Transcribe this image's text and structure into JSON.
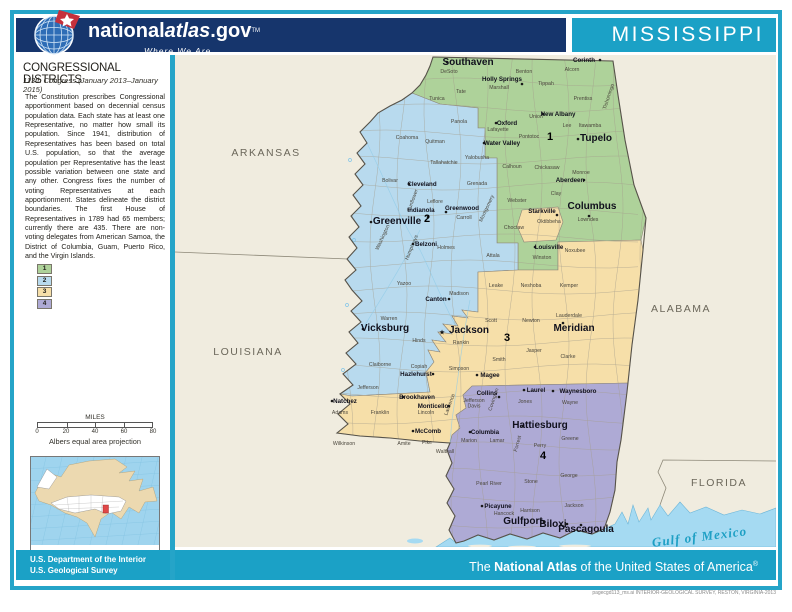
{
  "header": {
    "brand_prefix": "national",
    "brand_italic": "atlas",
    "brand_suffix": ".gov",
    "trademark": "TM",
    "tagline": "Where We Are",
    "state_title": "MISSISSIPPI"
  },
  "sidebar": {
    "title": "CONGRESSIONAL DISTRICTS",
    "subtitle": "113th Congress (January 2013–January 2015)",
    "body": "The Constitution prescribes Congressional apportionment based on decennial census population data.  Each state has at least one Representative, no matter how small its population.  Since 1941, distribution of Representatives has been based on total U.S. population, so that the average population per Representative has the least possible variation between one state and any other.  Congress fixes the number of voting Representatives at each apportionment.  States delineate the district boundaries.  The first House of Representatives in 1789 had 65 members; currently there are 435.  There are non-voting delegates from American Samoa, the District of Columbia, Guam, Puerto Rico, and the Virgin Islands.",
    "legend": [
      {
        "district": "1",
        "color": "#aed29a"
      },
      {
        "district": "2",
        "color": "#b8daee"
      },
      {
        "district": "3",
        "color": "#f6dfa9"
      },
      {
        "district": "4",
        "color": "#aeaad5"
      }
    ],
    "scale": {
      "label": "MILES",
      "ticks": [
        "0",
        "20",
        "40",
        "60",
        "80"
      ],
      "projection": "Albers equal area projection"
    }
  },
  "footer": {
    "doi_line1": "U.S. Department of the Interior",
    "doi_line2": "U.S. Geological Survey",
    "atlas_prefix": "The ",
    "atlas_bold": "National Atlas",
    "atlas_suffix": " of the United States of America",
    "atlas_reg": "®",
    "fine_print": "pagecgd113_ms.ai  INTERIOR-GEOLOGICAL SURVEY, RESTON, VIRGINIA-2013"
  },
  "map": {
    "colors": {
      "land": "#f0ecdf",
      "water": "#a5daf2",
      "district1": "#aed29a",
      "district2": "#b8daee",
      "district3": "#f6dfa9",
      "district4": "#aeaad5",
      "inset_water": "#9fd4ee",
      "inset_land": "#ecd9b0",
      "inset_us": "#ffffff",
      "inset_state": "#e04848"
    },
    "neighbors": [
      {
        "n": "ARKANSAS",
        "x": 266,
        "y": 156
      },
      {
        "n": "LOUISIANA",
        "x": 248,
        "y": 355
      },
      {
        "n": "ALABAMA",
        "x": 681,
        "y": 312
      },
      {
        "n": "FLORIDA",
        "x": 719,
        "y": 486
      }
    ],
    "water_label": {
      "n": "Gulf of Mexico",
      "x": 700,
      "y": 541,
      "r": -7
    },
    "district_numbers": [
      {
        "n": "1",
        "x": 550,
        "y": 140
      },
      {
        "n": "2",
        "x": 427,
        "y": 222
      },
      {
        "n": "3",
        "x": 507,
        "y": 341
      },
      {
        "n": "4",
        "x": 543,
        "y": 459
      }
    ],
    "cities": [
      {
        "n": "Southaven",
        "x": 468,
        "y": 65,
        "s": "b",
        "mx": 447,
        "my": 62
      },
      {
        "n": "Corinth",
        "x": 584,
        "y": 62,
        "s": "s",
        "mx": 600,
        "my": 60
      },
      {
        "n": "Holly Springs",
        "x": 502,
        "y": 81,
        "s": "s",
        "mx": 522,
        "my": 84
      },
      {
        "n": "New Albany",
        "x": 558,
        "y": 116,
        "s": "s",
        "mx": 543,
        "my": 114
      },
      {
        "n": "Oxford",
        "x": 507,
        "y": 125,
        "s": "s",
        "mx": 496,
        "my": 123
      },
      {
        "n": "Tupelo",
        "x": 596,
        "y": 141,
        "s": "b",
        "mx": 578,
        "my": 139
      },
      {
        "n": "Water Valley",
        "x": 502,
        "y": 145,
        "s": "s",
        "mx": 484,
        "my": 143
      },
      {
        "n": "Cleveland",
        "x": 422,
        "y": 186,
        "s": "s",
        "mx": 409,
        "my": 184
      },
      {
        "n": "Greenwood",
        "x": 462,
        "y": 210,
        "s": "s",
        "mx": 446,
        "my": 212
      },
      {
        "n": "Indianola",
        "x": 421,
        "y": 212,
        "s": "s",
        "mx": 428,
        "my": 217
      },
      {
        "n": "Greenville",
        "x": 397,
        "y": 224,
        "s": "b",
        "mx": 371,
        "my": 222
      },
      {
        "n": "Belzoni",
        "x": 426,
        "y": 246,
        "s": "s",
        "mx": 413,
        "my": 244
      },
      {
        "n": "Aberdeen",
        "x": 570,
        "y": 182,
        "s": "s",
        "mx": 584,
        "my": 180
      },
      {
        "n": "Starkville",
        "x": 542,
        "y": 213,
        "s": "s",
        "mx": 557,
        "my": 215
      },
      {
        "n": "Columbus",
        "x": 592,
        "y": 209,
        "s": "b",
        "mx": 589,
        "my": 216
      },
      {
        "n": "Louisville",
        "x": 549,
        "y": 249,
        "s": "s",
        "mx": 535,
        "my": 247
      },
      {
        "n": "Canton",
        "x": 436,
        "y": 301,
        "s": "s",
        "mx": 449,
        "my": 299
      },
      {
        "n": "Vicksburg",
        "x": 385,
        "y": 331,
        "s": "b",
        "mx": 363,
        "my": 329
      },
      {
        "n": "Jackson",
        "x": 469,
        "y": 333,
        "s": "b",
        "star": true,
        "mx": 442,
        "my": 332
      },
      {
        "n": "Meridian",
        "x": 574,
        "y": 331,
        "s": "b",
        "mx": 563,
        "my": 323
      },
      {
        "n": "Hazlehurst",
        "x": 416,
        "y": 376,
        "s": "s",
        "mx": 433,
        "my": 374
      },
      {
        "n": "Magee",
        "x": 490,
        "y": 377,
        "s": "s",
        "mx": 477,
        "my": 375
      },
      {
        "n": "Natchez",
        "x": 345,
        "y": 403,
        "s": "s",
        "mx": 332,
        "my": 401
      },
      {
        "n": "Brookhaven",
        "x": 417,
        "y": 399,
        "s": "s",
        "mx": 403,
        "my": 397
      },
      {
        "n": "Monticello",
        "x": 433,
        "y": 408,
        "s": "s",
        "mx": 449,
        "my": 406
      },
      {
        "n": "Collins",
        "x": 487,
        "y": 395,
        "s": "s",
        "mx": 499,
        "my": 397
      },
      {
        "n": "Laurel",
        "x": 536,
        "y": 392,
        "s": "s",
        "mx": 524,
        "my": 390
      },
      {
        "n": "Waynesboro",
        "x": 578,
        "y": 393,
        "s": "s",
        "mx": 553,
        "my": 391
      },
      {
        "n": "McComb",
        "x": 428,
        "y": 433,
        "s": "s",
        "mx": 413,
        "my": 431
      },
      {
        "n": "Columbia",
        "x": 485,
        "y": 434,
        "s": "s",
        "mx": 470,
        "my": 432
      },
      {
        "n": "Hattiesburg",
        "x": 540,
        "y": 428,
        "s": "b",
        "mx": 523,
        "my": 426
      },
      {
        "n": "Picayune",
        "x": 498,
        "y": 508,
        "s": "s",
        "mx": 482,
        "my": 506
      },
      {
        "n": "Gulfport",
        "x": 523,
        "y": 524,
        "s": "b",
        "mx": 544,
        "my": 522
      },
      {
        "n": "Biloxi",
        "x": 553,
        "y": 527,
        "s": "b",
        "mx": 567,
        "my": 524
      },
      {
        "n": "Pascagoula",
        "x": 586,
        "y": 532,
        "s": "b",
        "mx": 581,
        "my": 525
      }
    ],
    "counties": [
      {
        "n": "DeSoto",
        "x": 449,
        "y": 73
      },
      {
        "n": "Tunica",
        "x": 437,
        "y": 100
      },
      {
        "n": "Tate",
        "x": 461,
        "y": 93
      },
      {
        "n": "Marshall",
        "x": 499,
        "y": 89
      },
      {
        "n": "Benton",
        "x": 524,
        "y": 73
      },
      {
        "n": "Tippah",
        "x": 546,
        "y": 85
      },
      {
        "n": "Alcorn",
        "x": 572,
        "y": 71
      },
      {
        "n": "Tishomingo",
        "x": 610,
        "y": 97,
        "r": -72
      },
      {
        "n": "Prentiss",
        "x": 583,
        "y": 100
      },
      {
        "n": "Union",
        "x": 536,
        "y": 118
      },
      {
        "n": "Lee",
        "x": 567,
        "y": 127
      },
      {
        "n": "Itawamba",
        "x": 590,
        "y": 127
      },
      {
        "n": "Pontotoc",
        "x": 529,
        "y": 138
      },
      {
        "n": "Lafayette",
        "x": 498,
        "y": 131
      },
      {
        "n": "Panola",
        "x": 459,
        "y": 123
      },
      {
        "n": "Yalobusha",
        "x": 477,
        "y": 159
      },
      {
        "n": "Calhoun",
        "x": 512,
        "y": 168
      },
      {
        "n": "Chickasaw",
        "x": 547,
        "y": 169
      },
      {
        "n": "Monroe",
        "x": 581,
        "y": 174
      },
      {
        "n": "Webster",
        "x": 517,
        "y": 202
      },
      {
        "n": "Clay",
        "x": 556,
        "y": 195
      },
      {
        "n": "Oktibbeha",
        "x": 549,
        "y": 223
      },
      {
        "n": "Choctaw",
        "x": 514,
        "y": 229
      },
      {
        "n": "Lowndes",
        "x": 588,
        "y": 221
      },
      {
        "n": "Winston",
        "x": 542,
        "y": 259
      },
      {
        "n": "Noxubee",
        "x": 575,
        "y": 252
      },
      {
        "n": "Coahoma",
        "x": 407,
        "y": 139
      },
      {
        "n": "Quitman",
        "x": 435,
        "y": 143
      },
      {
        "n": "Tallahatchie",
        "x": 444,
        "y": 164
      },
      {
        "n": "Grenada",
        "x": 477,
        "y": 185
      },
      {
        "n": "Bolivar",
        "x": 390,
        "y": 182
      },
      {
        "n": "Sunflower",
        "x": 414,
        "y": 201,
        "r": -70
      },
      {
        "n": "Leflore",
        "x": 435,
        "y": 203
      },
      {
        "n": "Montgomery",
        "x": 488,
        "y": 209,
        "r": -65
      },
      {
        "n": "Carroll",
        "x": 464,
        "y": 219
      },
      {
        "n": "Washington",
        "x": 384,
        "y": 238,
        "r": -65
      },
      {
        "n": "Humphreys",
        "x": 413,
        "y": 248,
        "r": -68
      },
      {
        "n": "Holmes",
        "x": 446,
        "y": 249
      },
      {
        "n": "Attala",
        "x": 493,
        "y": 257
      },
      {
        "n": "Yazoo",
        "x": 404,
        "y": 285
      },
      {
        "n": "Madison",
        "x": 459,
        "y": 295
      },
      {
        "n": "Leake",
        "x": 496,
        "y": 287
      },
      {
        "n": "Neshoba",
        "x": 531,
        "y": 287
      },
      {
        "n": "Kemper",
        "x": 569,
        "y": 287
      },
      {
        "n": "Warren",
        "x": 389,
        "y": 320
      },
      {
        "n": "Hinds",
        "x": 419,
        "y": 342
      },
      {
        "n": "Rankin",
        "x": 461,
        "y": 344
      },
      {
        "n": "Scott",
        "x": 491,
        "y": 322
      },
      {
        "n": "Newton",
        "x": 531,
        "y": 322
      },
      {
        "n": "Lauderdale",
        "x": 569,
        "y": 317
      },
      {
        "n": "Smith",
        "x": 499,
        "y": 361
      },
      {
        "n": "Jasper",
        "x": 534,
        "y": 352
      },
      {
        "n": "Clarke",
        "x": 568,
        "y": 358
      },
      {
        "n": "Claiborne",
        "x": 380,
        "y": 366
      },
      {
        "n": "Copiah",
        "x": 419,
        "y": 368
      },
      {
        "n": "Simpson",
        "x": 459,
        "y": 370
      },
      {
        "n": "Jefferson",
        "x": 368,
        "y": 389
      },
      {
        "n": "Franklin",
        "x": 380,
        "y": 414
      },
      {
        "n": "Adams",
        "x": 340,
        "y": 414
      },
      {
        "n": "Wilkinson",
        "x": 344,
        "y": 445
      },
      {
        "n": "Amite",
        "x": 404,
        "y": 445
      },
      {
        "n": "Pike",
        "x": 427,
        "y": 444
      },
      {
        "n": "Walthall",
        "x": 445,
        "y": 453
      },
      {
        "n": "Lincoln",
        "x": 426,
        "y": 414
      },
      {
        "n": "Lawrence",
        "x": 451,
        "y": 405,
        "r": -70
      },
      {
        "n": "Jefferson\nDavis",
        "x": 474,
        "y": 402
      },
      {
        "n": "Covington",
        "x": 495,
        "y": 400,
        "r": -72
      },
      {
        "n": "Jones",
        "x": 525,
        "y": 403
      },
      {
        "n": "Wayne",
        "x": 570,
        "y": 404
      },
      {
        "n": "Marion",
        "x": 469,
        "y": 442
      },
      {
        "n": "Lamar",
        "x": 497,
        "y": 442
      },
      {
        "n": "Forrest",
        "x": 519,
        "y": 444,
        "r": -75
      },
      {
        "n": "Perry",
        "x": 540,
        "y": 447
      },
      {
        "n": "Greene",
        "x": 570,
        "y": 440
      },
      {
        "n": "Pearl River",
        "x": 489,
        "y": 485
      },
      {
        "n": "Stone",
        "x": 531,
        "y": 483
      },
      {
        "n": "George",
        "x": 569,
        "y": 477
      },
      {
        "n": "Hancock",
        "x": 504,
        "y": 515
      },
      {
        "n": "Harrison",
        "x": 530,
        "y": 512
      },
      {
        "n": "Jackson",
        "x": 574,
        "y": 507
      }
    ]
  }
}
